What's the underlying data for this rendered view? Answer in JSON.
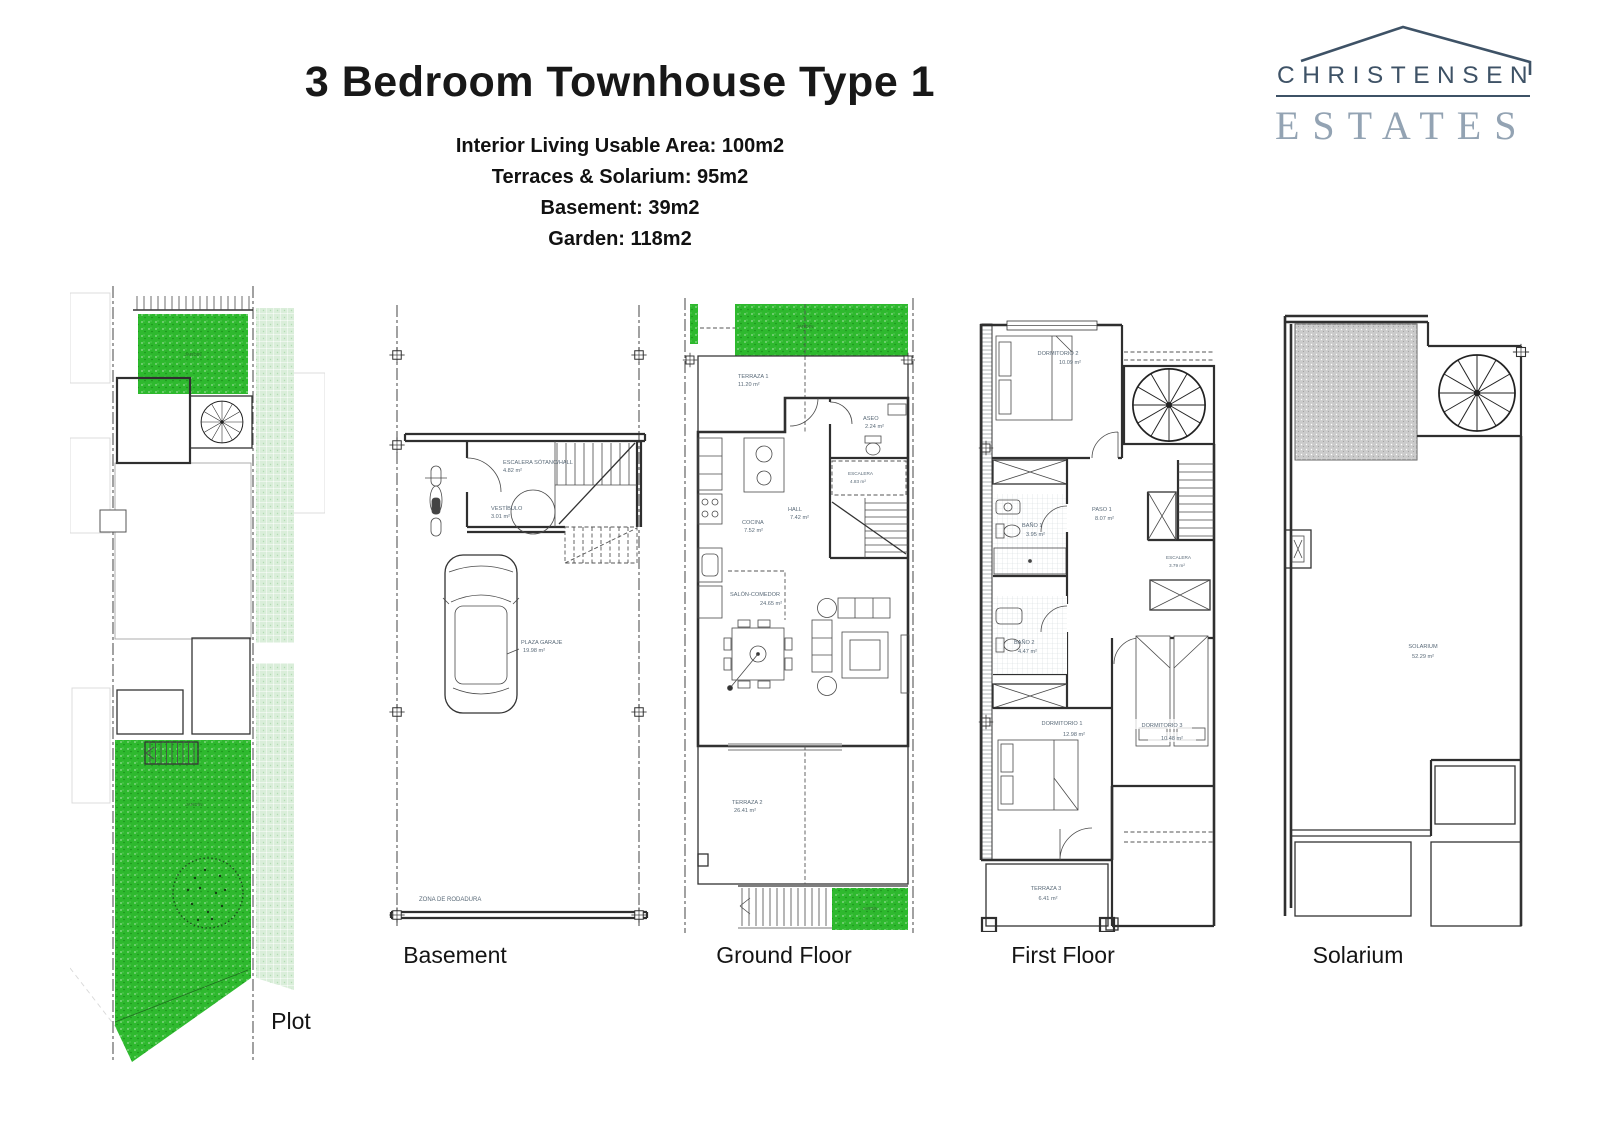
{
  "header": {
    "title": "3 Bedroom Townhouse Type 1",
    "specs": [
      "Interior Living Usable Area: 100m2",
      "Terraces & Solarium: 95m2",
      "Basement: 39m2",
      "Garden: 118m2"
    ]
  },
  "logo": {
    "name": "CHRISTENSEN",
    "type": "ESTATES"
  },
  "plans": {
    "plot": {
      "caption": "Plot",
      "garden_label": "JARDÍN"
    },
    "basement": {
      "caption": "Basement",
      "rooms": {
        "stairs_hall": {
          "name": "ESCALERA SÓTANO/HALL",
          "area": "4.82 m²"
        },
        "vestibule": {
          "name": "VESTÍBULO",
          "area": "3.01 m²"
        },
        "garage": {
          "name": "PLAZA GARAJE",
          "area": "19.98 m²"
        },
        "driveway": {
          "name": "ZONA DE RODADURA"
        }
      }
    },
    "ground": {
      "caption": "Ground Floor",
      "rooms": {
        "garden": {
          "name": "JARDÍN"
        },
        "terrace1": {
          "name": "TERRAZA 1",
          "area": "11.20 m²"
        },
        "aseo": {
          "name": "ASEO",
          "area": "2.24 m²"
        },
        "escalera": {
          "name": "ESCALERA",
          "area": "4.83 m²"
        },
        "hall": {
          "name": "HALL",
          "area": "7.42 m²"
        },
        "cocina": {
          "name": "COCINA",
          "area": "7.52 m²"
        },
        "salon": {
          "name": "SALÓN-COMEDOR",
          "area": "24.65 m²"
        },
        "terrace2": {
          "name": "TERRAZA 2",
          "area": "26.41 m²"
        },
        "garden2": {
          "name": "JARDÍN"
        }
      }
    },
    "first": {
      "caption": "First Floor",
      "rooms": {
        "dorm2": {
          "name": "DORMITORIO 2",
          "area": "10.09 m²"
        },
        "paso": {
          "name": "PASO 1",
          "area": "8.07 m²"
        },
        "bano1": {
          "name": "BAÑO 1",
          "area": "3.95 m²"
        },
        "escalera": {
          "name": "ESCALERA",
          "area": "3.79 m²"
        },
        "bano2": {
          "name": "BAÑO 2",
          "area": "4.47 m²"
        },
        "dorm1": {
          "name": "DORMITORIO 1",
          "area": "12.98 m²"
        },
        "dorm3": {
          "name": "DORMITORIO 3",
          "area": "10.48 m²"
        },
        "terrace3": {
          "name": "TERRAZA 3",
          "area": "6.41 m²"
        }
      }
    },
    "solarium": {
      "caption": "Solarium",
      "rooms": {
        "solarium": {
          "name": "SOLARIUM",
          "area": "52.29 m²"
        }
      }
    }
  },
  "colors": {
    "grass": "#2eb92e",
    "grass_light": "#daeeda",
    "label": "#5a6a78",
    "logo_dark": "#3e5266",
    "logo_light": "#93a3b3",
    "roof_gray": "#cbcbcb",
    "caption": "#141414"
  }
}
